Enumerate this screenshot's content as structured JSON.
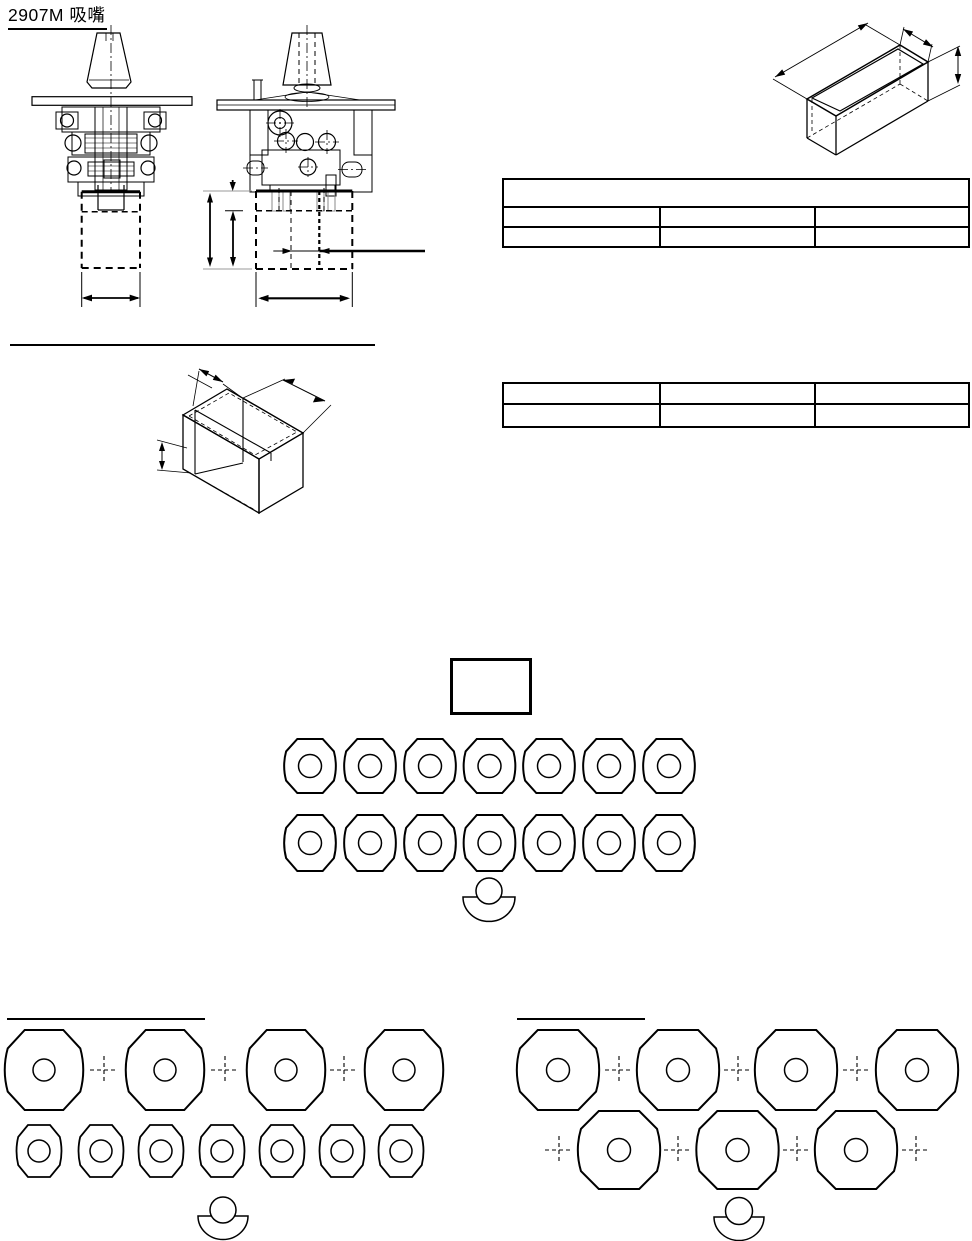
{
  "page": {
    "title": "2907M 吸嘴"
  },
  "tables": {
    "upper": {
      "header": "",
      "rows": [
        [
          "",
          "",
          ""
        ],
        [
          "",
          "",
          ""
        ]
      ]
    },
    "lower": {
      "rows": [
        [
          "",
          "",
          ""
        ],
        [
          "",
          "",
          ""
        ]
      ]
    }
  },
  "nozzle_groups": {
    "middle": {
      "row_counts": [
        7,
        7
      ],
      "crosshair_count": 0,
      "has_holder": true
    },
    "bottom_left": {
      "row_counts": [
        4,
        7
      ],
      "crosshair_count": 3,
      "has_holder": true
    },
    "bottom_right": {
      "row_counts": [
        4,
        3
      ],
      "crosshair_count": 7,
      "has_holder": true
    }
  }
}
